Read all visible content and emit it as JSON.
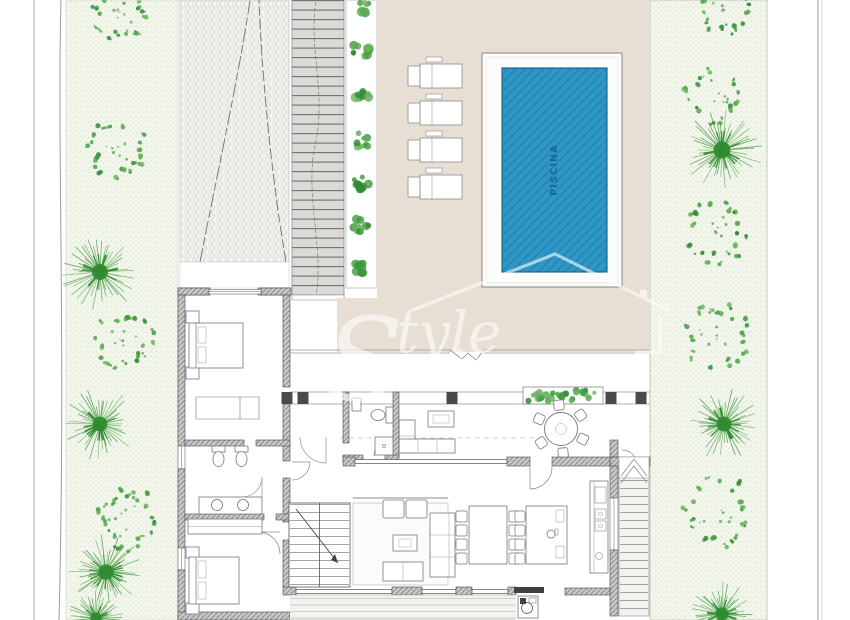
{
  "title": "Villa ground floor site plan",
  "pool": {
    "label": "PISCINA",
    "water_color": "#2e97c6",
    "edge_color": "#135e86"
  },
  "watermark": {
    "brand": "Style",
    "subtitle": "PROPERTIES",
    "color": "#ffffff"
  },
  "palette": {
    "terrace": "#e7dfd3",
    "garden_strip": "#f4f7ee",
    "tree_greens": [
      "#3f9b3f",
      "#57a84e",
      "#2f8a2f",
      "#6ab35f"
    ],
    "paving": "#dadad6",
    "wall_fill": "#c9c9c9",
    "driveway": "#f3f3f1"
  },
  "site": {
    "left_garden_trees": [
      {
        "kind": "ring",
        "x": 120,
        "y": 12,
        "r": 30
      },
      {
        "kind": "ring",
        "x": 117,
        "y": 148,
        "r": 33
      },
      {
        "kind": "star",
        "x": 100,
        "y": 272,
        "r": 40
      },
      {
        "kind": "ring",
        "x": 124,
        "y": 340,
        "r": 32
      },
      {
        "kind": "star",
        "x": 100,
        "y": 424,
        "r": 37
      },
      {
        "kind": "ring",
        "x": 127,
        "y": 520,
        "r": 34
      },
      {
        "kind": "star",
        "x": 106,
        "y": 572,
        "r": 38
      },
      {
        "kind": "star",
        "x": 96,
        "y": 618,
        "r": 28
      }
    ],
    "right_garden_trees": [
      {
        "kind": "ring",
        "x": 722,
        "y": 10,
        "r": 28
      },
      {
        "kind": "ring",
        "x": 714,
        "y": 95,
        "r": 31
      },
      {
        "kind": "star",
        "x": 722,
        "y": 150,
        "r": 42
      },
      {
        "kind": "ring",
        "x": 715,
        "y": 232,
        "r": 35
      },
      {
        "kind": "ring",
        "x": 716,
        "y": 336,
        "r": 35
      },
      {
        "kind": "star",
        "x": 724,
        "y": 424,
        "r": 37
      },
      {
        "kind": "ring",
        "x": 717,
        "y": 512,
        "r": 38
      },
      {
        "kind": "star",
        "x": 722,
        "y": 614,
        "r": 33
      }
    ],
    "planter_bushes_y": [
      8,
      52,
      96,
      140,
      184,
      226,
      266
    ],
    "loungers_y": [
      64,
      101,
      138,
      175
    ],
    "porch_columns_x": [
      287,
      303,
      452,
      611,
      641
    ],
    "hedge": {
      "x": 523,
      "y": 387,
      "w": 80,
      "h": 17
    },
    "round_table": {
      "cx": 561,
      "cy": 429,
      "r": 16.5,
      "chairs": 6
    },
    "dining_chair_rows": {
      "left_x": 456,
      "right_x": 509,
      "ys": [
        511,
        525,
        539,
        553
      ]
    },
    "island_stools": {
      "x": 515,
      "ys": [
        511,
        525,
        539,
        553
      ]
    }
  }
}
